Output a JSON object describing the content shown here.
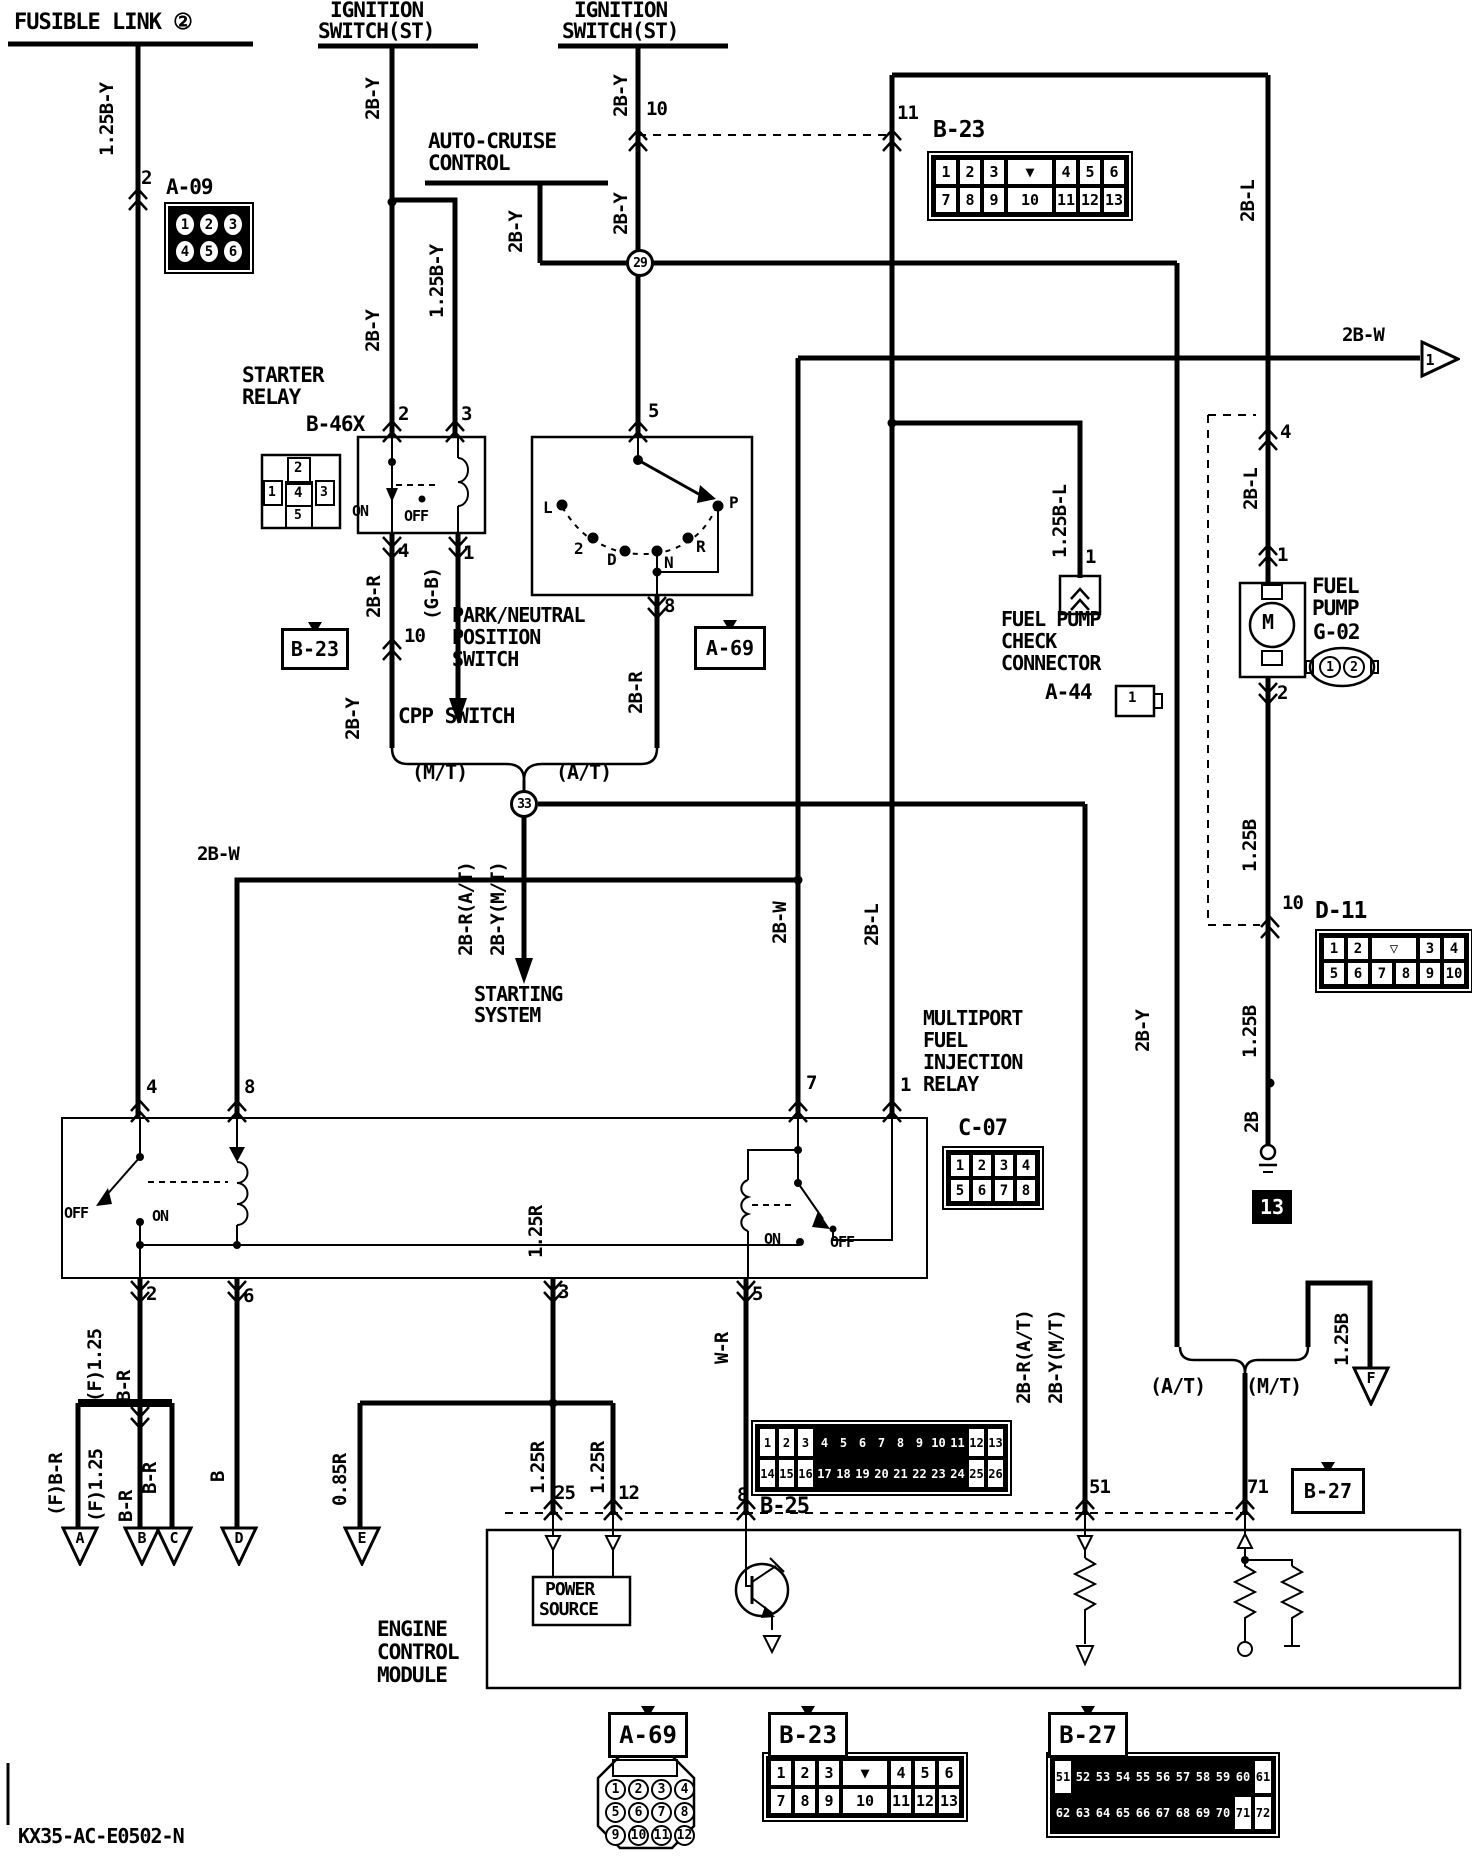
{
  "diagram_code": "KX35-AC-E0502-N",
  "junctions": [
    {
      "n": "junction-29",
      "t": "29",
      "x": 640,
      "y": 263
    },
    {
      "n": "junction-33",
      "t": "33",
      "x": 524,
      "y": 804
    }
  ],
  "ground": {
    "n": "ground-13",
    "t": "13",
    "x": 1252,
    "y": 1190
  },
  "labels": [
    {
      "n": "fusible-link-title",
      "t": "FUSIBLE LINK ②",
      "x": 14,
      "y": 12,
      "s": 22
    },
    {
      "n": "wire-125by-1",
      "t": "1.25B-Y",
      "x": 98,
      "y": 156,
      "r": 1
    },
    {
      "n": "pin-2-a09",
      "t": "2",
      "x": 141,
      "y": 169
    },
    {
      "n": "conn-a09-name",
      "t": "A-09",
      "x": 166,
      "y": 177,
      "s": 21
    },
    {
      "n": "ignition-1-line1",
      "t": "IGNITION",
      "x": 330,
      "y": 0,
      "s": 21
    },
    {
      "n": "ignition-1-line2",
      "t": "SWITCH(ST)",
      "x": 318,
      "y": 21,
      "s": 21
    },
    {
      "n": "ignition-2-line1",
      "t": "IGNITION",
      "x": 574,
      "y": 0,
      "s": 21
    },
    {
      "n": "ignition-2-line2",
      "t": "SWITCH(ST)",
      "x": 562,
      "y": 21,
      "s": 21
    },
    {
      "n": "wire-2by-ign1-a",
      "t": "2B-Y",
      "x": 364,
      "y": 120,
      "r": 1
    },
    {
      "n": "wire-2by-ign1-b",
      "t": "2B-Y",
      "x": 364,
      "y": 352,
      "r": 1
    },
    {
      "n": "wire-125by-branch",
      "t": "1.25B-Y",
      "x": 428,
      "y": 318,
      "r": 1
    },
    {
      "n": "auto-cruise-line1",
      "t": "AUTO-CRUISE",
      "x": 428,
      "y": 131,
      "s": 21
    },
    {
      "n": "auto-cruise-line2",
      "t": "CONTROL",
      "x": 428,
      "y": 153,
      "s": 21
    },
    {
      "n": "wire-2by-ac",
      "t": "2B-Y",
      "x": 507,
      "y": 253,
      "r": 1
    },
    {
      "n": "wire-2by-ign2-a",
      "t": "2B-Y",
      "x": 612,
      "y": 117,
      "r": 1
    },
    {
      "n": "wire-2by-ign2-b",
      "t": "2B-Y",
      "x": 612,
      "y": 235,
      "r": 1
    },
    {
      "n": "splice-10-label",
      "t": "10",
      "x": 646,
      "y": 100
    },
    {
      "n": "splice-11-label",
      "t": "11",
      "x": 897,
      "y": 104
    },
    {
      "n": "conn-b23-top-name",
      "t": "B-23",
      "x": 933,
      "y": 119,
      "s": 23
    },
    {
      "n": "wire-2bl-1",
      "t": "2B-L",
      "x": 1239,
      "y": 222,
      "r": 1
    },
    {
      "n": "wire-2bw-out",
      "t": "2B-W",
      "x": 1342,
      "y": 326
    },
    {
      "n": "starter-relay-line1",
      "t": "STARTER",
      "x": 242,
      "y": 365,
      "s": 21
    },
    {
      "n": "starter-relay-line2",
      "t": "RELAY",
      "x": 242,
      "y": 387,
      "s": 21
    },
    {
      "n": "conn-b46x-name",
      "t": "B-46X",
      "x": 306,
      "y": 414,
      "s": 21
    },
    {
      "n": "b46x-cell-2",
      "t": "2",
      "x": 294,
      "y": 461,
      "s": 14
    },
    {
      "n": "b46x-cell-1",
      "t": "1",
      "x": 268,
      "y": 486,
      "s": 13
    },
    {
      "n": "b46x-cell-4",
      "t": "4",
      "x": 294,
      "y": 486,
      "s": 14
    },
    {
      "n": "b46x-cell-3",
      "t": "3",
      "x": 320,
      "y": 486,
      "s": 13
    },
    {
      "n": "b46x-cell-5",
      "t": "5",
      "x": 294,
      "y": 509,
      "s": 13
    },
    {
      "n": "b46x-pin2",
      "t": "2",
      "x": 398,
      "y": 405
    },
    {
      "n": "b46x-pin3",
      "t": "3",
      "x": 461,
      "y": 405
    },
    {
      "n": "b46x-on",
      "t": "ON",
      "x": 352,
      "y": 504,
      "s": 15
    },
    {
      "n": "b46x-off",
      "t": "OFF",
      "x": 404,
      "y": 509,
      "s": 15
    },
    {
      "n": "b46x-pin4",
      "t": "4",
      "x": 398,
      "y": 542
    },
    {
      "n": "b46x-pin1",
      "t": "1",
      "x": 463,
      "y": 544
    },
    {
      "n": "wire-2br-1",
      "t": "2B-R",
      "x": 365,
      "y": 618,
      "r": 1
    },
    {
      "n": "wire-gb",
      "t": "(G-B)",
      "x": 423,
      "y": 620,
      "r": 1
    },
    {
      "n": "splice-10b-label",
      "t": "10",
      "x": 404,
      "y": 627
    },
    {
      "n": "wire-2by-cpp",
      "t": "2B-Y",
      "x": 344,
      "y": 740,
      "r": 1
    },
    {
      "n": "pn-pin5",
      "t": "5",
      "x": 648,
      "y": 402
    },
    {
      "n": "pn-pos-l",
      "t": "L",
      "x": 543,
      "y": 500,
      "s": 16
    },
    {
      "n": "pn-pos-2",
      "t": "2",
      "x": 574,
      "y": 541,
      "s": 16
    },
    {
      "n": "pn-pos-d",
      "t": "D",
      "x": 607,
      "y": 552,
      "s": 16
    },
    {
      "n": "pn-pos-n",
      "t": "N",
      "x": 664,
      "y": 555,
      "s": 16
    },
    {
      "n": "pn-pos-r",
      "t": "R",
      "x": 696,
      "y": 539,
      "s": 16
    },
    {
      "n": "pn-pos-p",
      "t": "P",
      "x": 729,
      "y": 495,
      "s": 16
    },
    {
      "n": "pn-pin8",
      "t": "8",
      "x": 664,
      "y": 597
    },
    {
      "n": "pn-title-1",
      "t": "PARK/NEUTRAL",
      "x": 452,
      "y": 605,
      "s": 20
    },
    {
      "n": "pn-title-2",
      "t": "POSITION",
      "x": 452,
      "y": 627,
      "s": 20
    },
    {
      "n": "pn-title-3",
      "t": "SWITCH",
      "x": 452,
      "y": 649,
      "s": 20
    },
    {
      "n": "wire-2br-2",
      "t": "2B-R",
      "x": 627,
      "y": 714,
      "r": 1
    },
    {
      "n": "cpp-switch-title",
      "t": "CPP SWITCH",
      "x": 398,
      "y": 706,
      "s": 21
    },
    {
      "n": "cpp-mt",
      "t": "(M/T)",
      "x": 412,
      "y": 762,
      "s": 20
    },
    {
      "n": "cpp-at",
      "t": "(A/T)",
      "x": 556,
      "y": 762,
      "s": 20
    },
    {
      "n": "wire-2brat-1",
      "t": "2B-R(A/T)",
      "x": 457,
      "y": 956,
      "r": 1
    },
    {
      "n": "wire-2bymt-1",
      "t": "2B-Y(M/T)",
      "x": 489,
      "y": 956,
      "r": 1
    },
    {
      "n": "starting-system-1",
      "t": "STARTING",
      "x": 474,
      "y": 984,
      "s": 20
    },
    {
      "n": "starting-system-2",
      "t": "SYSTEM",
      "x": 474,
      "y": 1005,
      "s": 20
    },
    {
      "n": "wire-2bw-mid",
      "t": "2B-W",
      "x": 197,
      "y": 845
    },
    {
      "n": "wire-2bw-v",
      "t": "2B-W",
      "x": 771,
      "y": 944,
      "r": 1
    },
    {
      "n": "wire-2bl-2",
      "t": "2B-L",
      "x": 863,
      "y": 946,
      "r": 1
    },
    {
      "n": "wire-2by-long",
      "t": "2B-Y",
      "x": 1134,
      "y": 1052,
      "r": 1
    },
    {
      "n": "fp-pin4",
      "t": "4",
      "x": 1280,
      "y": 423
    },
    {
      "n": "wire-2bl-3",
      "t": "2B-L",
      "x": 1242,
      "y": 510,
      "r": 1
    },
    {
      "n": "fpc-pin1",
      "t": "1",
      "x": 1085,
      "y": 548
    },
    {
      "n": "wire-125bl",
      "t": "1.25B-L",
      "x": 1051,
      "y": 558,
      "r": 1
    },
    {
      "n": "fp-pin1",
      "t": "1",
      "x": 1277,
      "y": 546
    },
    {
      "n": "fp-motor-m",
      "t": "M",
      "x": 1262,
      "y": 612,
      "s": 20
    },
    {
      "n": "fuel-pump-1",
      "t": "FUEL",
      "x": 1312,
      "y": 576,
      "s": 21
    },
    {
      "n": "fuel-pump-2",
      "t": "PUMP",
      "x": 1312,
      "y": 598,
      "s": 21
    },
    {
      "n": "conn-g02-name",
      "t": "G-02",
      "x": 1313,
      "y": 622,
      "s": 21
    },
    {
      "n": "fp-pin2",
      "t": "2",
      "x": 1277,
      "y": 684
    },
    {
      "n": "fpc-title-1",
      "t": "FUEL PUMP",
      "x": 1001,
      "y": 609,
      "s": 20
    },
    {
      "n": "fpc-title-2",
      "t": "CHECK",
      "x": 1001,
      "y": 631,
      "s": 20
    },
    {
      "n": "fpc-title-3",
      "t": "CONNECTOR",
      "x": 1001,
      "y": 653,
      "s": 20
    },
    {
      "n": "conn-a44-name",
      "t": "A-44",
      "x": 1045,
      "y": 682,
      "s": 21
    },
    {
      "n": "a44-pin1",
      "t": "1",
      "x": 1128,
      "y": 691,
      "s": 14
    },
    {
      "n": "wire-125b-1",
      "t": "1.25B",
      "x": 1241,
      "y": 872,
      "r": 1
    },
    {
      "n": "d11-pin10",
      "t": "10",
      "x": 1282,
      "y": 894
    },
    {
      "n": "conn-d11-name",
      "t": "D-11",
      "x": 1315,
      "y": 900,
      "s": 23
    },
    {
      "n": "wire-125b-2",
      "t": "1.25B",
      "x": 1241,
      "y": 1058,
      "r": 1
    },
    {
      "n": "wire-2b",
      "t": "2B",
      "x": 1243,
      "y": 1133,
      "r": 1
    },
    {
      "n": "m-relay-1",
      "t": "MULTIPORT",
      "x": 923,
      "y": 1008,
      "s": 20
    },
    {
      "n": "m-relay-2",
      "t": "FUEL",
      "x": 923,
      "y": 1030,
      "s": 20
    },
    {
      "n": "m-relay-3",
      "t": "INJECTION",
      "x": 923,
      "y": 1052,
      "s": 20
    },
    {
      "n": "m-relay-4",
      "t": "RELAY",
      "x": 923,
      "y": 1074,
      "s": 20
    },
    {
      "n": "relay-pin4",
      "t": "4",
      "x": 146,
      "y": 1078
    },
    {
      "n": "relay-pin8",
      "t": "8",
      "x": 244,
      "y": 1078
    },
    {
      "n": "relay-pin7",
      "t": "7",
      "x": 806,
      "y": 1074
    },
    {
      "n": "relay-pin1",
      "t": "1",
      "x": 900,
      "y": 1076
    },
    {
      "n": "relay-l-off",
      "t": "OFF",
      "x": 64,
      "y": 1206,
      "s": 15
    },
    {
      "n": "relay-l-on",
      "t": "ON",
      "x": 152,
      "y": 1209,
      "s": 15
    },
    {
      "n": "relay-r-on",
      "t": "ON",
      "x": 764,
      "y": 1232,
      "s": 15
    },
    {
      "n": "relay-r-off",
      "t": "OFF",
      "x": 830,
      "y": 1235,
      "s": 15
    },
    {
      "n": "relay-pin2",
      "t": "2",
      "x": 146,
      "y": 1285
    },
    {
      "n": "relay-pin6",
      "t": "6",
      "x": 243,
      "y": 1287
    },
    {
      "n": "relay-pin3",
      "t": "3",
      "x": 558,
      "y": 1283
    },
    {
      "n": "relay-pin5",
      "t": "5",
      "x": 752,
      "y": 1285
    },
    {
      "n": "conn-c07-name",
      "t": "C-07",
      "x": 958,
      "y": 1118,
      "s": 22
    },
    {
      "n": "wire-125r-0",
      "t": "1.25R",
      "x": 527,
      "y": 1258,
      "r": 1
    },
    {
      "n": "wire-f125-top",
      "t": "(F)1.25",
      "x": 86,
      "y": 1402,
      "r": 1
    },
    {
      "n": "wire-br-top",
      "t": "B-R",
      "x": 115,
      "y": 1402,
      "r": 1
    },
    {
      "n": "wire-fbr",
      "t": "(F)B-R",
      "x": 47,
      "y": 1516,
      "r": 1
    },
    {
      "n": "wire-f125-b",
      "t": "(F)1.25",
      "x": 87,
      "y": 1522,
      "r": 1
    },
    {
      "n": "wire-br-b",
      "t": "B-R",
      "x": 117,
      "y": 1522,
      "r": 1
    },
    {
      "n": "wire-br-c",
      "t": "B-R",
      "x": 141,
      "y": 1494,
      "r": 1
    },
    {
      "n": "wire-b-d",
      "t": "B",
      "x": 209,
      "y": 1482,
      "r": 1
    },
    {
      "n": "wire-085r",
      "t": "0.85R",
      "x": 331,
      "y": 1506,
      "r": 1
    },
    {
      "n": "wire-wr",
      "t": "W-R",
      "x": 713,
      "y": 1364,
      "r": 1
    },
    {
      "n": "wire-125r-1",
      "t": "1.25R",
      "x": 529,
      "y": 1494,
      "r": 1
    },
    {
      "n": "wire-125r-2",
      "t": "1.25R",
      "x": 589,
      "y": 1494,
      "r": 1
    },
    {
      "n": "ecm-pin25",
      "t": "25",
      "x": 554,
      "y": 1484
    },
    {
      "n": "ecm-pin12",
      "t": "12",
      "x": 618,
      "y": 1484
    },
    {
      "n": "ecm-pin8",
      "t": "8",
      "x": 737,
      "y": 1486
    },
    {
      "n": "conn-b25-name",
      "t": "B-25",
      "x": 760,
      "y": 1496,
      "s": 22
    },
    {
      "n": "wire-2brat-2",
      "t": "2B-R(A/T)",
      "x": 1015,
      "y": 1404,
      "r": 1
    },
    {
      "n": "wire-2bymt-2",
      "t": "2B-Y(M/T)",
      "x": 1047,
      "y": 1404,
      "r": 1
    },
    {
      "n": "ecm-pin51",
      "t": "51",
      "x": 1089,
      "y": 1478
    },
    {
      "n": "ecm-pin71",
      "t": "71",
      "x": 1247,
      "y": 1478
    },
    {
      "n": "bottom-at",
      "t": "(A/T)",
      "x": 1150,
      "y": 1376,
      "s": 20
    },
    {
      "n": "bottom-mt",
      "t": "(M/T)",
      "x": 1246,
      "y": 1376,
      "s": 20
    },
    {
      "n": "wire-125b-f",
      "t": "1.25B",
      "x": 1333,
      "y": 1366,
      "r": 1
    },
    {
      "n": "power-source-1",
      "t": "POWER",
      "x": 545,
      "y": 1581,
      "s": 18
    },
    {
      "n": "power-source-2",
      "t": "SOURCE",
      "x": 539,
      "y": 1601,
      "s": 18
    },
    {
      "n": "ecm-title-1",
      "t": "ENGINE",
      "x": 377,
      "y": 1619,
      "s": 21
    },
    {
      "n": "ecm-title-2",
      "t": "CONTROL",
      "x": 377,
      "y": 1642,
      "s": 21
    },
    {
      "n": "ecm-title-3",
      "t": "MODULE",
      "x": 377,
      "y": 1665,
      "s": 21
    },
    {
      "n": "diagram-code-label",
      "t": "KX35-AC-E0502-N",
      "x": 18,
      "y": 1826,
      "s": 20
    }
  ],
  "grids": [
    {
      "n": "conn-a09",
      "x": 168,
      "y": 206,
      "cw": 24,
      "ch": 27,
      "fs": 14,
      "circled": true,
      "dark": true,
      "rows": [
        [
          "1",
          "2",
          "3"
        ],
        [
          "4",
          "5",
          "6"
        ]
      ]
    },
    {
      "n": "conn-b23-top",
      "x": 931,
      "y": 155,
      "cw": 24,
      "ch": 28,
      "fs": 15,
      "wide": [
        "▼",
        "10"
      ],
      "rows": [
        [
          "1",
          "2",
          "3",
          "▼",
          "4",
          "5",
          "6"
        ],
        [
          "7",
          "8",
          "9",
          "10",
          "11",
          "12",
          "13"
        ]
      ]
    },
    {
      "n": "conn-d11",
      "x": 1319,
      "y": 933,
      "cw": 24,
      "ch": 25,
      "fs": 14,
      "wide": [
        "▽"
      ],
      "rows": [
        [
          "1",
          "2",
          "▽",
          "3",
          "4"
        ],
        [
          "5",
          "6",
          "7",
          "8",
          "9",
          "10"
        ]
      ]
    },
    {
      "n": "conn-c07",
      "x": 946,
      "y": 1150,
      "cw": 22,
      "ch": 25,
      "fs": 14,
      "rows": [
        [
          "1",
          "2",
          "3",
          "4"
        ],
        [
          "5",
          "6",
          "7",
          "8"
        ]
      ]
    },
    {
      "n": "conn-b25",
      "x": 755,
      "y": 1424,
      "cw": 19,
      "ch": 31,
      "fs": 12,
      "black": [
        "4",
        "5",
        "6",
        "7",
        "8",
        "9",
        "10",
        "11",
        "17",
        "18",
        "19",
        "20",
        "21",
        "22",
        "23",
        "24"
      ],
      "rows": [
        [
          "1",
          "2",
          "3",
          "4",
          "5",
          "6",
          "7",
          "8",
          "9",
          "10",
          "11",
          "12",
          "13"
        ],
        [
          "14",
          "15",
          "16",
          "17",
          "18",
          "19",
          "20",
          "21",
          "22",
          "23",
          "24",
          "25",
          "26"
        ]
      ]
    },
    {
      "n": "conn-b27-bottom",
      "x": 1050,
      "y": 1756,
      "cw": 20,
      "ch": 36,
      "fs": 12,
      "black": [
        "52",
        "53",
        "54",
        "55",
        "56",
        "57",
        "58",
        "59",
        "60",
        "62",
        "63",
        "64",
        "65",
        "66",
        "67",
        "68",
        "69",
        "70"
      ],
      "rows": [
        [
          "51",
          "52",
          "53",
          "54",
          "55",
          "56",
          "57",
          "58",
          "59",
          "60",
          "61"
        ],
        [
          "62",
          "63",
          "64",
          "65",
          "66",
          "67",
          "68",
          "69",
          "70",
          "71",
          "72"
        ]
      ]
    },
    {
      "n": "conn-b23-bottom",
      "x": 766,
      "y": 1756,
      "cw": 24,
      "ch": 28,
      "fs": 15,
      "wide": [
        "▼",
        "10"
      ],
      "rows": [
        [
          "1",
          "2",
          "3",
          "▼",
          "4",
          "5",
          "6"
        ],
        [
          "7",
          "8",
          "9",
          "10",
          "11",
          "12",
          "13"
        ]
      ]
    },
    {
      "n": "conn-a69-bottom",
      "x": 604,
      "y": 1778,
      "cw": 23,
      "ch": 23,
      "fs": 13,
      "circled": true,
      "noframe": true,
      "rows": [
        [
          "1",
          "2",
          "3",
          "4"
        ],
        [
          "5",
          "6",
          "7",
          "8"
        ],
        [
          "9",
          "10",
          "11",
          "12"
        ]
      ]
    },
    {
      "n": "conn-g02",
      "x": 1318,
      "y": 655,
      "cw": 24,
      "ch": 24,
      "fs": 13,
      "circled": true,
      "noframe": true,
      "rows": [
        [
          "1",
          "2"
        ]
      ]
    }
  ],
  "tags": [
    {
      "n": "tag-b23-mid",
      "t": "B-23",
      "x": 281,
      "y": 628,
      "w": 62,
      "h": 36,
      "fs": 20
    },
    {
      "n": "tag-a69-mid",
      "t": "A-69",
      "x": 694,
      "y": 626,
      "w": 66,
      "h": 38,
      "fs": 20
    },
    {
      "n": "tag-b27-mid",
      "t": "B-27",
      "x": 1291,
      "y": 1468,
      "w": 68,
      "h": 40,
      "fs": 20
    },
    {
      "n": "tag-a69-bottom",
      "t": "A-69",
      "x": 608,
      "y": 1712,
      "w": 74,
      "h": 40,
      "fs": 24
    },
    {
      "n": "tag-b23-bottom",
      "t": "B-23",
      "x": 768,
      "y": 1712,
      "w": 74,
      "h": 40,
      "fs": 24
    },
    {
      "n": "tag-b27-bottom",
      "t": "B-27",
      "x": 1048,
      "y": 1712,
      "w": 74,
      "h": 40,
      "fs": 24
    }
  ],
  "arrows": [
    {
      "n": "arrow-a",
      "t": "A",
      "x": 61,
      "y": 1526,
      "d": "down"
    },
    {
      "n": "arrow-b",
      "t": "B",
      "x": 123,
      "y": 1526,
      "d": "down"
    },
    {
      "n": "arrow-c",
      "t": "C",
      "x": 155,
      "y": 1526,
      "d": "down"
    },
    {
      "n": "arrow-d",
      "t": "D",
      "x": 220,
      "y": 1526,
      "d": "down"
    },
    {
      "n": "arrow-e",
      "t": "E",
      "x": 343,
      "y": 1526,
      "d": "down"
    },
    {
      "n": "arrow-f",
      "t": "F",
      "x": 1352,
      "y": 1366,
      "d": "down"
    },
    {
      "n": "arrow-1-out",
      "t": "1",
      "x": 1420,
      "y": 340,
      "d": "right"
    }
  ]
}
